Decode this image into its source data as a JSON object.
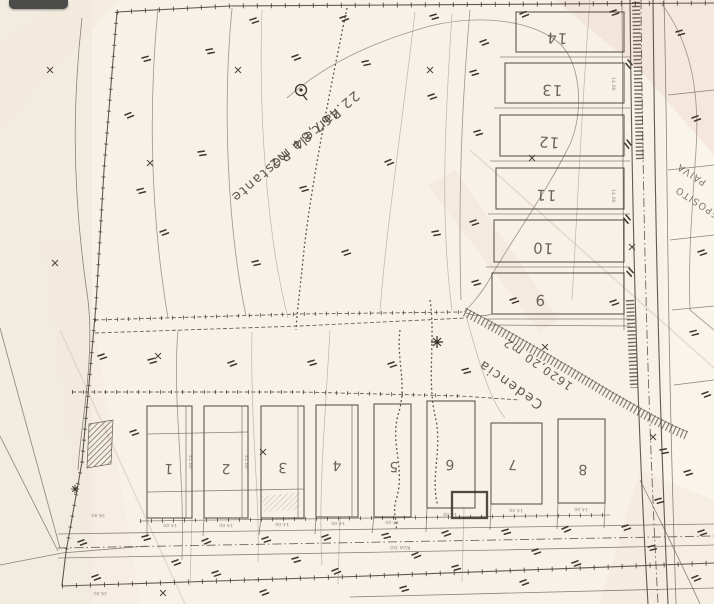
{
  "palette": {
    "paper": "#f7f1e7",
    "ink": "#46403a",
    "faint_contour": "#8e8276",
    "overlay_dark": "#4b4b49",
    "pink_wash": "#f0d8cc"
  },
  "map": {
    "labels": {
      "parcela_line1": "Parcela Restante",
      "parcela_line2": "22.467,84 m2",
      "cedencia_line1": "Cedencia",
      "cedencia_line2": "1620,20 m2",
      "road_bottom": "RUA DO",
      "edge_fragment_top": "PAIVA",
      "edge_fragment_bottom": "DEPOSITO"
    },
    "upper_lots": [
      "14",
      "13",
      "12",
      "11",
      "10",
      "9"
    ],
    "lower_lots": [
      "1",
      "2",
      "3",
      "4",
      "5",
      "6",
      "7",
      "8"
    ],
    "dimensions": {
      "lot_width": "14.00",
      "left_a": "26.92",
      "left_b": "26.92",
      "depth": "41.00"
    }
  }
}
